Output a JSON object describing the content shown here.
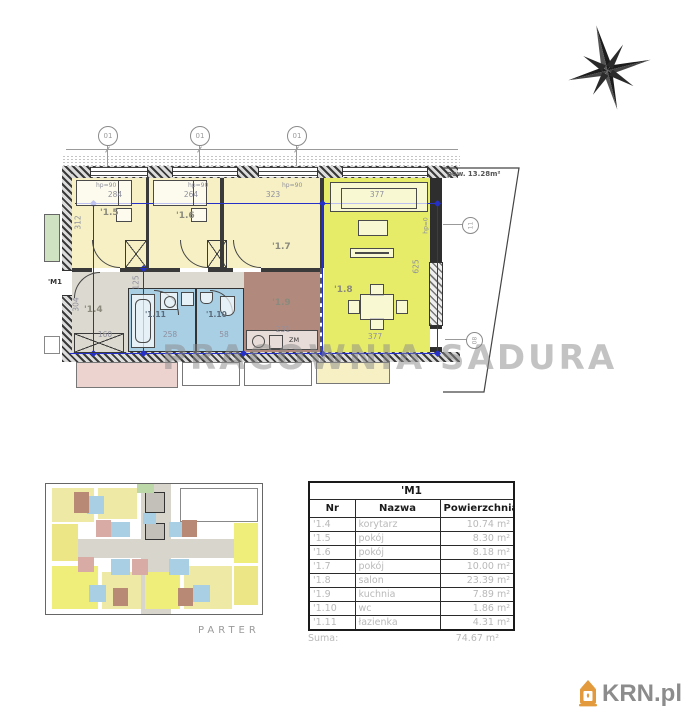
{
  "plan": {
    "unit_label": "'M1",
    "balcony_area": "pow. 13.28m²",
    "watermark": "PRACOWNIA SADURA",
    "labels": {
      "r14": "'1.4",
      "r15": "'1.5",
      "r16": "'1.6",
      "r17": "'1.7",
      "r18": "'1.8",
      "r19": "'1.9",
      "r110": "'1.10",
      "r111": "'1.11"
    },
    "dims": {
      "w15": "284",
      "w16": "264",
      "w17": "323",
      "w18_top": "377",
      "w18_bottom": "377",
      "h_left": "312",
      "h_right": "625",
      "h_corridor": "304",
      "h_inner": "125",
      "w_corridor": "160",
      "w_bath": "258",
      "w_wc": "58",
      "w_kitchen": "231"
    },
    "sills": {
      "s1": "hp=90",
      "s2": "hp=90",
      "s3": "hp=90",
      "s4": "hp=0"
    },
    "grid_bubbles": {
      "b1": "01",
      "b2": "01",
      "b3": "01",
      "b4": "11",
      "b5": "08"
    },
    "counter_label": "ZM"
  },
  "overview": {
    "caption": "PARTER"
  },
  "table": {
    "title": "'M1",
    "columns": {
      "nr": "Nr",
      "name": "Nazwa",
      "area": "Powierzchnia"
    },
    "rows": [
      {
        "nr": "'1.4",
        "name": "korytarz",
        "area": "10.74 m²"
      },
      {
        "nr": "'1.5",
        "name": "pokój",
        "area": "8.30 m²"
      },
      {
        "nr": "'1.6",
        "name": "pokój",
        "area": "8.18 m²"
      },
      {
        "nr": "'1.7",
        "name": "pokój",
        "area": "10.00 m²"
      },
      {
        "nr": "'1.8",
        "name": "salon",
        "area": "23.39 m²"
      },
      {
        "nr": "'1.9",
        "name": "kuchnia",
        "area": "7.89 m²"
      },
      {
        "nr": "'1.10",
        "name": "wc",
        "area": "1.86 m²"
      },
      {
        "nr": "'1.11",
        "name": "łazienka",
        "area": "4.31 m²"
      }
    ],
    "suma_label": "Suma:",
    "suma_value": "74.67 m²"
  },
  "logo": {
    "text": "KRN.pl"
  },
  "colors": {
    "room_yellow": "#f6f0c4",
    "salon_yellow": "#e6ec68",
    "corridor_gray": "#dcd9d0",
    "bath_blue": "#a9cfe5",
    "kitchen_brown": "#b28a7d",
    "neighbor_pink": "#ecd3cf",
    "green": "#cfe3c3",
    "dim_blue": "#2430c8",
    "logo_orange": "#E29A3C"
  }
}
